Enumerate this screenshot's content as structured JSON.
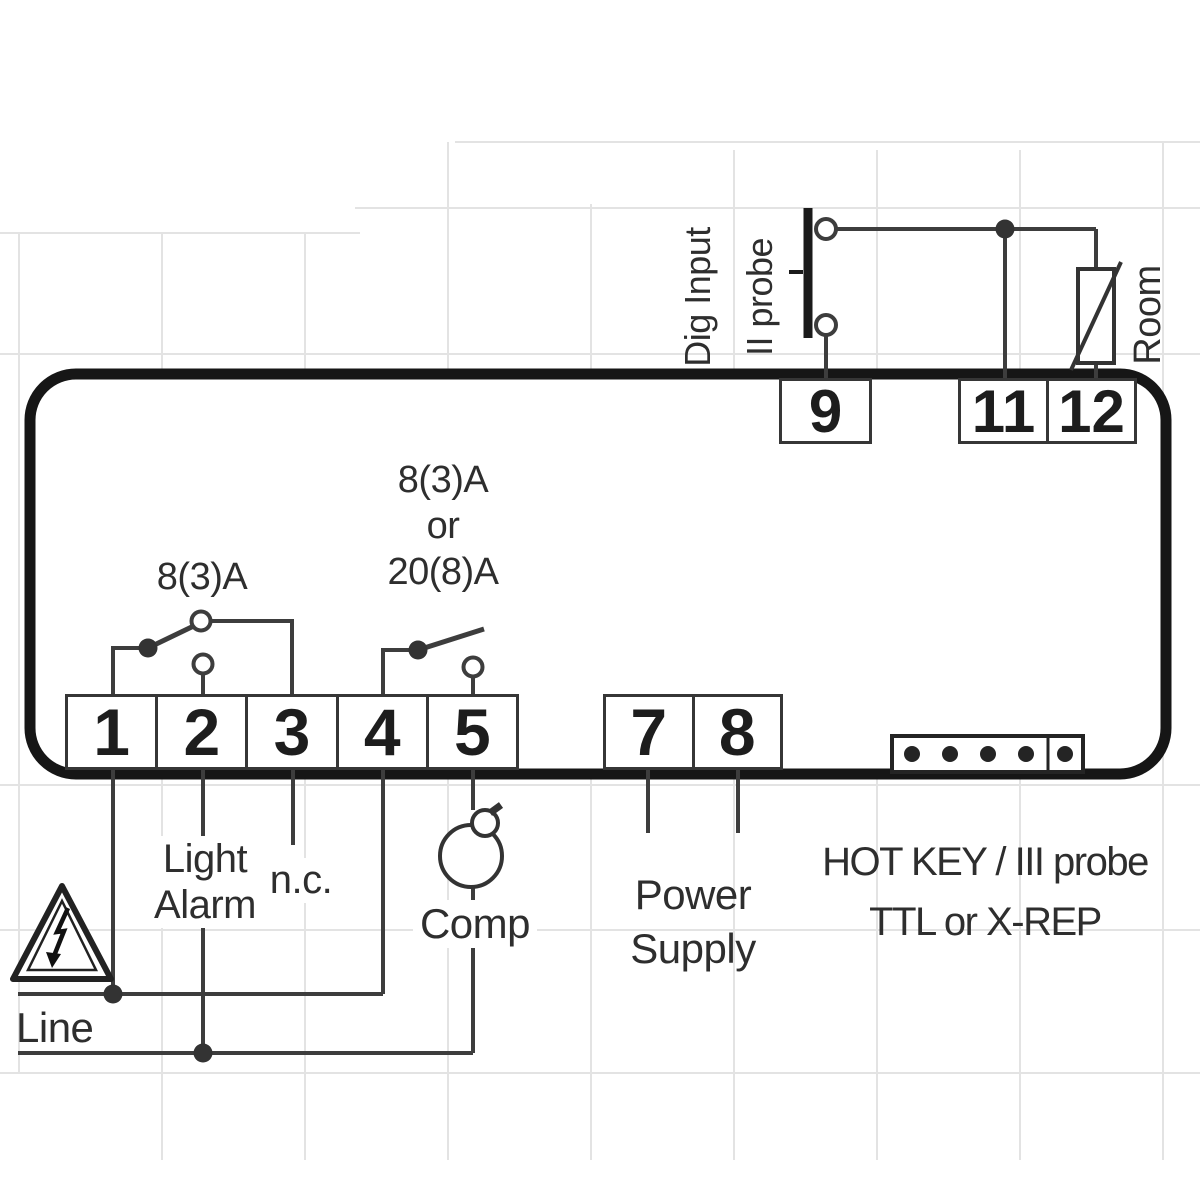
{
  "terminals": {
    "bottom": [
      "1",
      "2",
      "3",
      "4",
      "5"
    ],
    "power": [
      "7",
      "8"
    ],
    "top": [
      "9",
      "11",
      "12"
    ]
  },
  "labels": {
    "relay1_rating": "8(3)A",
    "relay2_rating_line1": "8(3)A",
    "relay2_rating_line2": "or",
    "relay2_rating_line3": "20(8)A",
    "dig_input_line1": "Dig Input",
    "dig_input_line2": "II probe",
    "room_probe": "Room",
    "light_alarm_line1": "Light",
    "light_alarm_line2": "Alarm",
    "not_connected": "n.c.",
    "compressor": "Comp",
    "power_supply_line1": "Power",
    "power_supply_line2": "Supply",
    "hotkey_line1": "HOT KEY / III probe",
    "hotkey_line2": "TTL or X-REP",
    "line": "Line"
  },
  "icons": {
    "hazard": "warning-triangle-icon",
    "compressor": "compressor-lamp-icon",
    "dig_input_switch": "momentary-switch-icon",
    "room_probe": "thermistor-icon",
    "hotkey_port": "ttl-connector-icon",
    "relay_left": "relay-contact-icon",
    "relay_right": "relay-contact-icon"
  },
  "colors": {
    "background": "#ffffff",
    "grid": "#e3e3e3",
    "body_outline": "#161616",
    "wire": "#3d3d3d",
    "text": "#2e2e2e"
  }
}
